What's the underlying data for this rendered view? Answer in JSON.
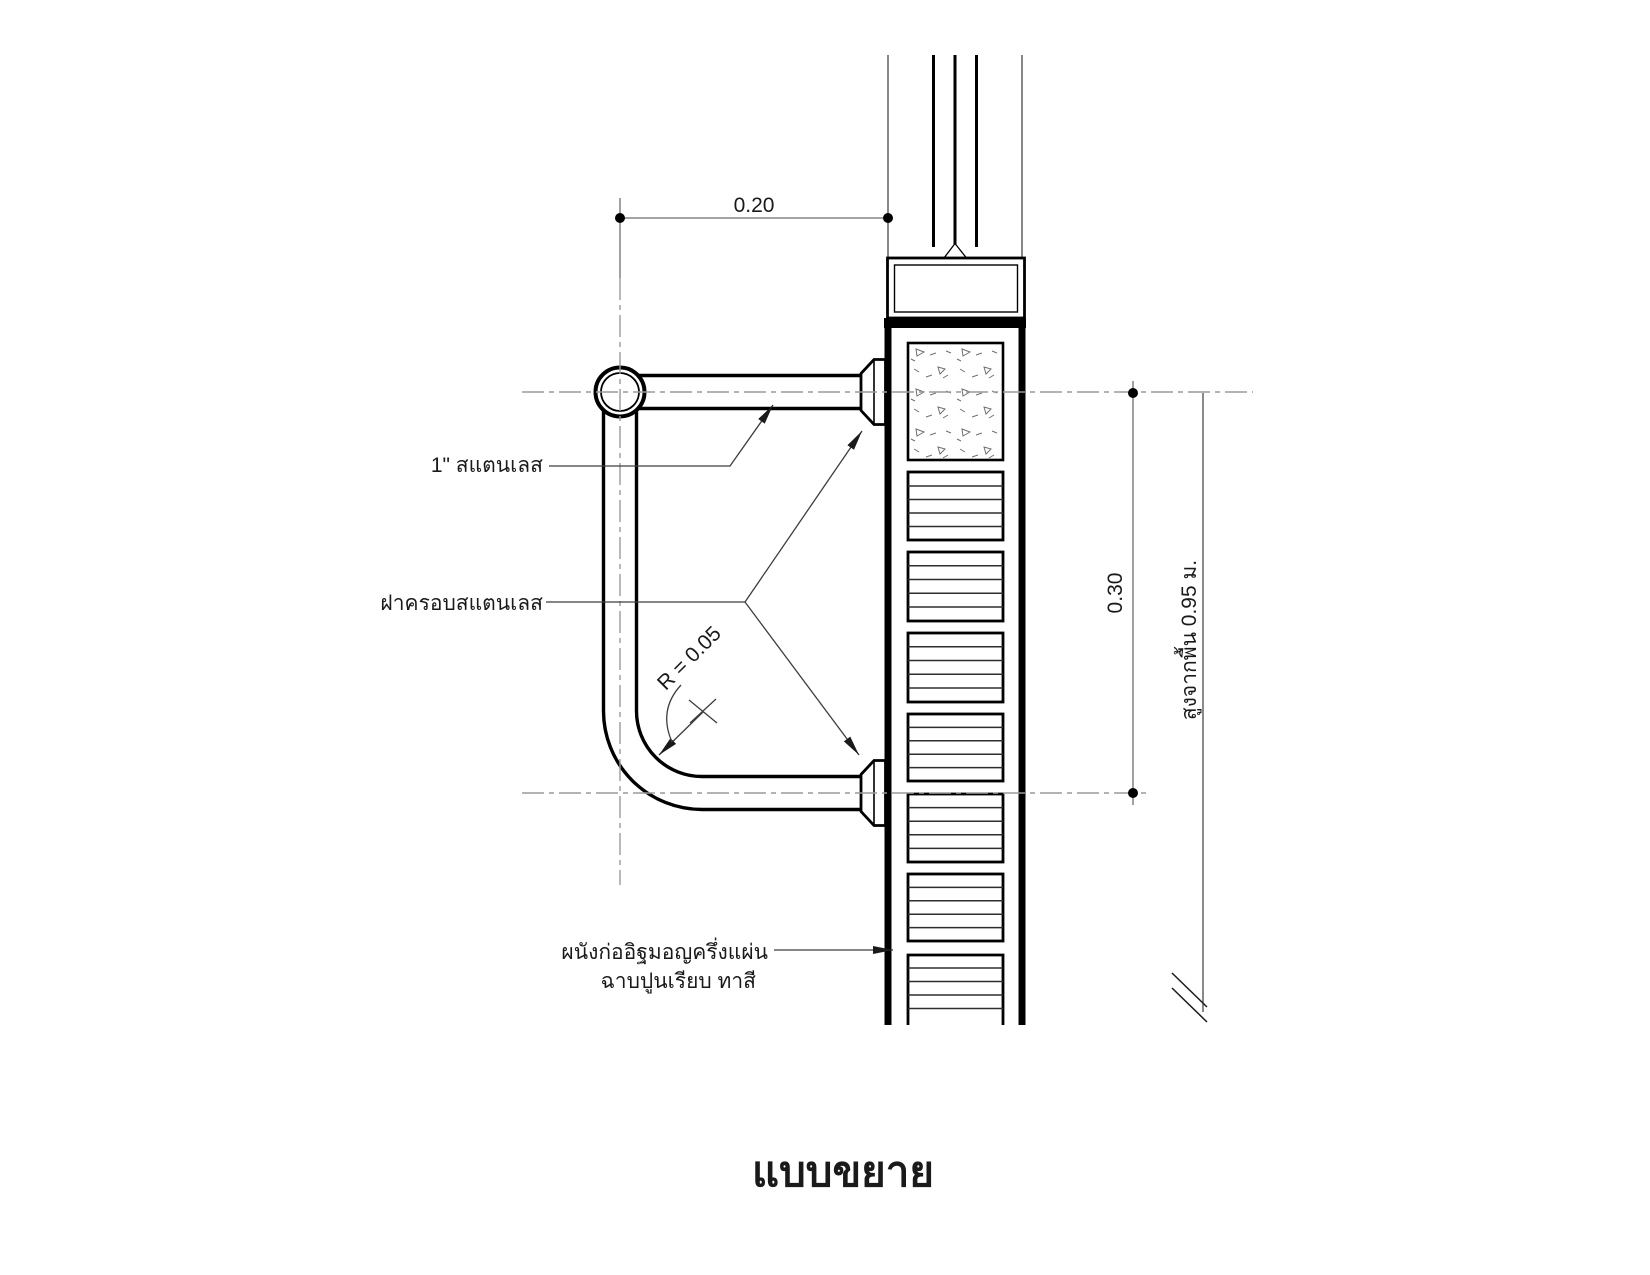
{
  "drawing": {
    "title": "แบบขยาย",
    "dimensions": {
      "offset_from_wall": "0.20",
      "rail_spacing": "0.30",
      "bend_radius": "R = 0.05",
      "height_from_floor": "สูงจากพื้น 0.95 ม."
    },
    "labels": {
      "rail_size": "1\" สแตนเลส",
      "cover_plate": "ฝาครอบสแตนเลส",
      "wall_spec_line1": "ผนังก่ออิฐมอญครึ่งแผ่น",
      "wall_spec_line2": "ฉาบปูนเรียบ ทาสี"
    },
    "colors": {
      "object_line": "#000000",
      "center_line": "#9a9a9a",
      "dimension_line": "#6e6e6e",
      "leader_line": "#3d3d3d",
      "text": "#1a1a1a",
      "background": "#ffffff"
    }
  }
}
